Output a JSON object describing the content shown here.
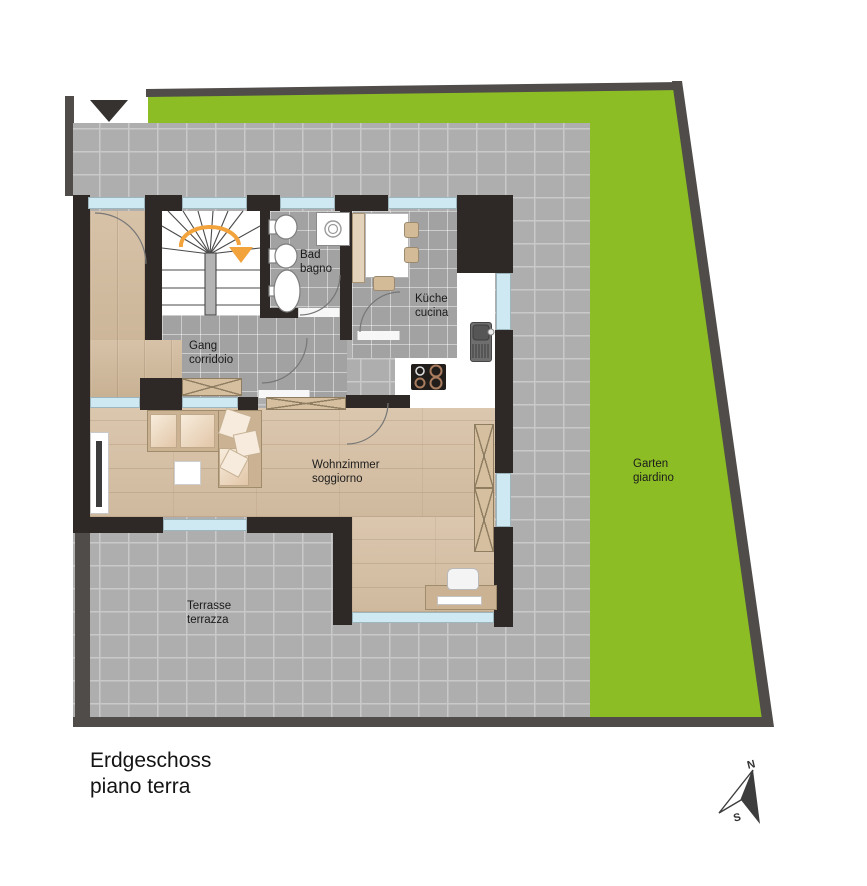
{
  "plan": {
    "title": {
      "de": "Erdgeschoss",
      "it": "piano terra"
    },
    "rooms": {
      "bathroom": {
        "de": "Bad",
        "it": "bagno"
      },
      "kitchen": {
        "de": "Küche",
        "it": "cucina"
      },
      "corridor": {
        "de": "Gang",
        "it": "corridoio"
      },
      "living_room": {
        "de": "Wohnzimmer",
        "it": "soggiorno"
      },
      "terrace": {
        "de": "Terrasse",
        "it": "terrazza"
      },
      "garden": {
        "de": "Garten",
        "it": "giardino"
      }
    },
    "compass": {
      "north": "N",
      "south": "S"
    },
    "colors": {
      "garden_green": "#8cbd25",
      "paving_gray": "#aeaeae",
      "indoor_tile_gray": "#a2a2a2",
      "wall_dark": "#2e2926",
      "site_border_gray": "#4f4c4a",
      "window_blue": "#cfe9f2",
      "wood_floor": "#d5c0a5",
      "stair_arrow_orange": "#f3a33c"
    }
  }
}
